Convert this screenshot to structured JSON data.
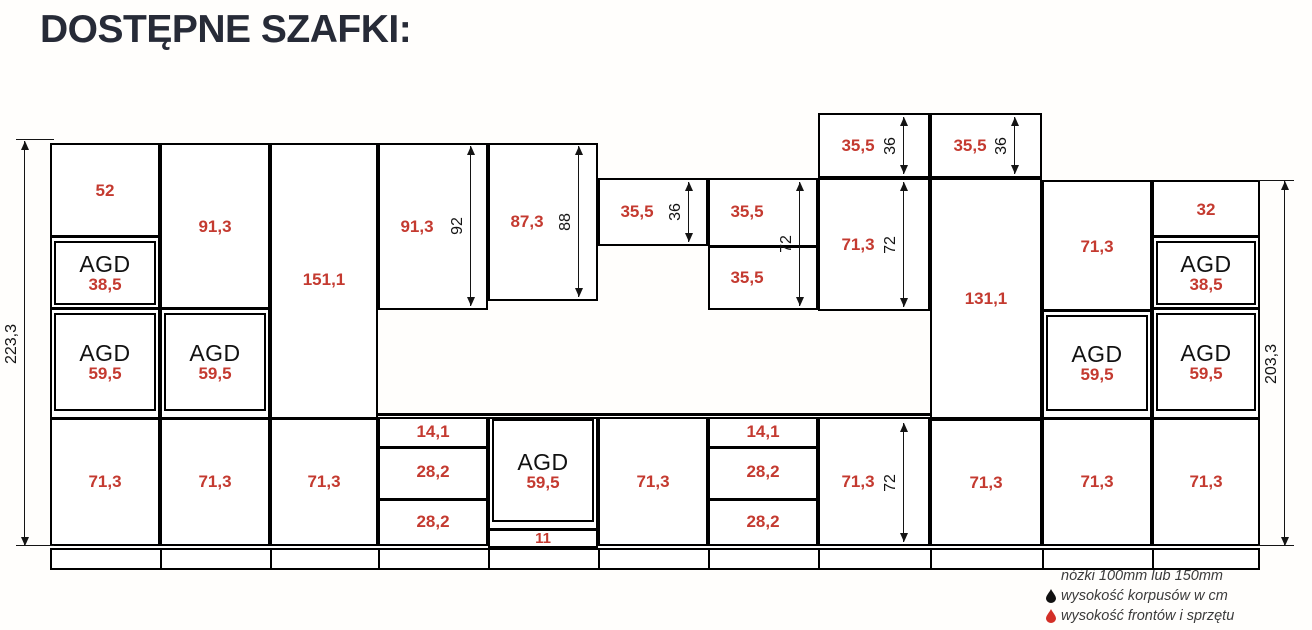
{
  "title": "DOSTĘPNE SZAFKI:",
  "colors": {
    "front_height_red": "#c43a30",
    "line_ink": "#141414",
    "title_ink": "#272b37",
    "background": "#fffefc"
  },
  "legend": {
    "feet_note": "nóżki 100mm lub 150mm",
    "black_drop_label": "wysokość korpusów w cm",
    "red_drop_label": "wysokość frontów i sprzętu"
  },
  "diagram": {
    "units": [
      {
        "x": 50,
        "y": 143,
        "w": 110,
        "h": 403,
        "sections": [
          {
            "type": "plain",
            "label": "52",
            "y": 143,
            "h": 96
          },
          {
            "type": "agd",
            "name": "AGD",
            "num": "38,5",
            "y": 239,
            "h": 72
          },
          {
            "type": "agd",
            "name": "AGD",
            "num": "59,5",
            "y": 311,
            "h": 106
          },
          {
            "type": "plain",
            "label": "71,3",
            "y": 417,
            "h": 129
          }
        ]
      },
      {
        "x": 160,
        "y": 143,
        "w": 110,
        "h": 403,
        "sections": [
          {
            "type": "plain",
            "label": "91,3",
            "y": 143,
            "h": 168
          },
          {
            "type": "agd",
            "name": "AGD",
            "num": "59,5",
            "y": 311,
            "h": 106
          },
          {
            "type": "plain",
            "label": "71,3",
            "y": 417,
            "h": 129
          }
        ]
      },
      {
        "x": 270,
        "y": 143,
        "w": 108,
        "h": 403,
        "sections": [
          {
            "type": "plain",
            "label": "151,1",
            "y": 143,
            "h": 274
          },
          {
            "type": "plain",
            "label": "71,3",
            "y": 417,
            "h": 129
          }
        ]
      },
      {
        "x": 378,
        "y": 143,
        "w": 110,
        "h": 167,
        "sections": [
          {
            "type": "plain",
            "label": "91,3",
            "y": 143,
            "h": 167,
            "shift": -16
          }
        ]
      },
      {
        "x": 378,
        "y": 417,
        "w": 110,
        "h": 129,
        "sections": [
          {
            "type": "plain",
            "label": "14,1",
            "y": 417,
            "h": 29
          },
          {
            "type": "plain",
            "label": "28,2",
            "y": 446,
            "h": 52
          },
          {
            "type": "plain",
            "label": "28,2",
            "y": 498,
            "h": 48
          }
        ]
      },
      {
        "x": 488,
        "y": 143,
        "w": 110,
        "h": 158,
        "sections": [
          {
            "type": "plain",
            "label": "87,3",
            "y": 143,
            "h": 158,
            "shift": -16
          }
        ]
      },
      {
        "x": 488,
        "y": 417,
        "w": 110,
        "h": 131,
        "sections": [
          {
            "type": "agd",
            "name": "AGD",
            "num": "59,5",
            "y": 417,
            "h": 111
          },
          {
            "type": "plain",
            "label": "11",
            "y": 528,
            "h": 20,
            "small": true
          }
        ]
      },
      {
        "x": 598,
        "y": 178,
        "w": 110,
        "h": 68,
        "sections": [
          {
            "type": "plain",
            "label": "35,5",
            "y": 178,
            "h": 68,
            "shift": -16
          }
        ]
      },
      {
        "x": 598,
        "y": 417,
        "w": 110,
        "h": 129,
        "sections": [
          {
            "type": "plain",
            "label": "71,3",
            "y": 417,
            "h": 129
          }
        ]
      },
      {
        "x": 708,
        "y": 178,
        "w": 110,
        "h": 132,
        "sections": [
          {
            "type": "plain",
            "label": "35,5",
            "y": 178,
            "h": 67,
            "shift": -16
          },
          {
            "type": "plain",
            "label": "35,5",
            "y": 245,
            "h": 65,
            "shift": -16
          }
        ]
      },
      {
        "x": 708,
        "y": 417,
        "w": 110,
        "h": 129,
        "sections": [
          {
            "type": "plain",
            "label": "14,1",
            "y": 417,
            "h": 29
          },
          {
            "type": "plain",
            "label": "28,2",
            "y": 446,
            "h": 52
          },
          {
            "type": "plain",
            "label": "28,2",
            "y": 498,
            "h": 48
          }
        ]
      },
      {
        "x": 818,
        "y": 113,
        "w": 112,
        "h": 65,
        "sections": [
          {
            "type": "plain",
            "label": "35,5",
            "y": 113,
            "h": 65,
            "shift": -16
          }
        ]
      },
      {
        "x": 818,
        "y": 178,
        "w": 112,
        "h": 133,
        "sections": [
          {
            "type": "plain",
            "label": "71,3",
            "y": 178,
            "h": 133,
            "shift": -16
          }
        ]
      },
      {
        "x": 818,
        "y": 417,
        "w": 112,
        "h": 129,
        "sections": [
          {
            "type": "plain",
            "label": "71,3",
            "y": 417,
            "h": 129,
            "shift": -16
          }
        ]
      },
      {
        "x": 930,
        "y": 113,
        "w": 112,
        "h": 65,
        "sections": [
          {
            "type": "plain",
            "label": "35,5",
            "y": 113,
            "h": 65,
            "shift": -16
          }
        ]
      },
      {
        "x": 930,
        "y": 178,
        "w": 112,
        "h": 241,
        "sections": [
          {
            "type": "plain",
            "label": "131,1",
            "y": 178,
            "h": 241
          }
        ]
      },
      {
        "x": 930,
        "y": 419,
        "w": 112,
        "h": 127,
        "sections": [
          {
            "type": "plain",
            "label": "71,3",
            "y": 419,
            "h": 127
          }
        ]
      },
      {
        "x": 1042,
        "y": 180,
        "w": 110,
        "h": 366,
        "sections": [
          {
            "type": "plain",
            "label": "71,3",
            "y": 180,
            "h": 133
          },
          {
            "type": "agd",
            "name": "AGD",
            "num": "59,5",
            "y": 313,
            "h": 104
          },
          {
            "type": "plain",
            "label": "71,3",
            "y": 417,
            "h": 129
          }
        ]
      },
      {
        "x": 1152,
        "y": 180,
        "w": 108,
        "h": 366,
        "sections": [
          {
            "type": "plain",
            "label": "32",
            "y": 180,
            "h": 59
          },
          {
            "type": "agd",
            "name": "AGD",
            "num": "38,5",
            "y": 239,
            "h": 72
          },
          {
            "type": "agd",
            "name": "AGD",
            "num": "59,5",
            "y": 311,
            "h": 106
          },
          {
            "type": "plain",
            "label": "71,3",
            "y": 417,
            "h": 129
          }
        ]
      }
    ],
    "dims": [
      {
        "label": "223,3",
        "x": 24,
        "y1": 141,
        "y2": 546,
        "ext": [
          {
            "x": 16,
            "y": 139,
            "w": 38
          },
          {
            "x": 16,
            "y": 545,
            "w": 38
          }
        ]
      },
      {
        "label": "92",
        "x": 470,
        "y1": 146,
        "y2": 306
      },
      {
        "label": "88",
        "x": 578,
        "y1": 146,
        "y2": 297
      },
      {
        "label": "36",
        "x": 688,
        "y1": 182,
        "y2": 242
      },
      {
        "label": "72",
        "x": 799,
        "y1": 182,
        "y2": 306
      },
      {
        "label": "36",
        "x": 903,
        "y1": 117,
        "y2": 174
      },
      {
        "label": "72",
        "x": 903,
        "y1": 182,
        "y2": 307
      },
      {
        "label": "36",
        "x": 1014,
        "y1": 117,
        "y2": 174
      },
      {
        "label": "72",
        "x": 903,
        "y1": 423,
        "y2": 542
      },
      {
        "label": "203,3",
        "x": 1284,
        "y1": 181,
        "y2": 546,
        "ext": [
          {
            "x": 1258,
            "y": 180,
            "w": 36
          },
          {
            "x": 1258,
            "y": 545,
            "w": 36
          }
        ]
      }
    ],
    "counter_line": {
      "x": 376,
      "y": 413,
      "w": 556,
      "h": 3
    },
    "plinth": {
      "x": 50,
      "y": 548,
      "w": 1210,
      "h": 22,
      "dividers": [
        160,
        270,
        378,
        488,
        598,
        708,
        818,
        930,
        1042,
        1152
      ]
    }
  }
}
